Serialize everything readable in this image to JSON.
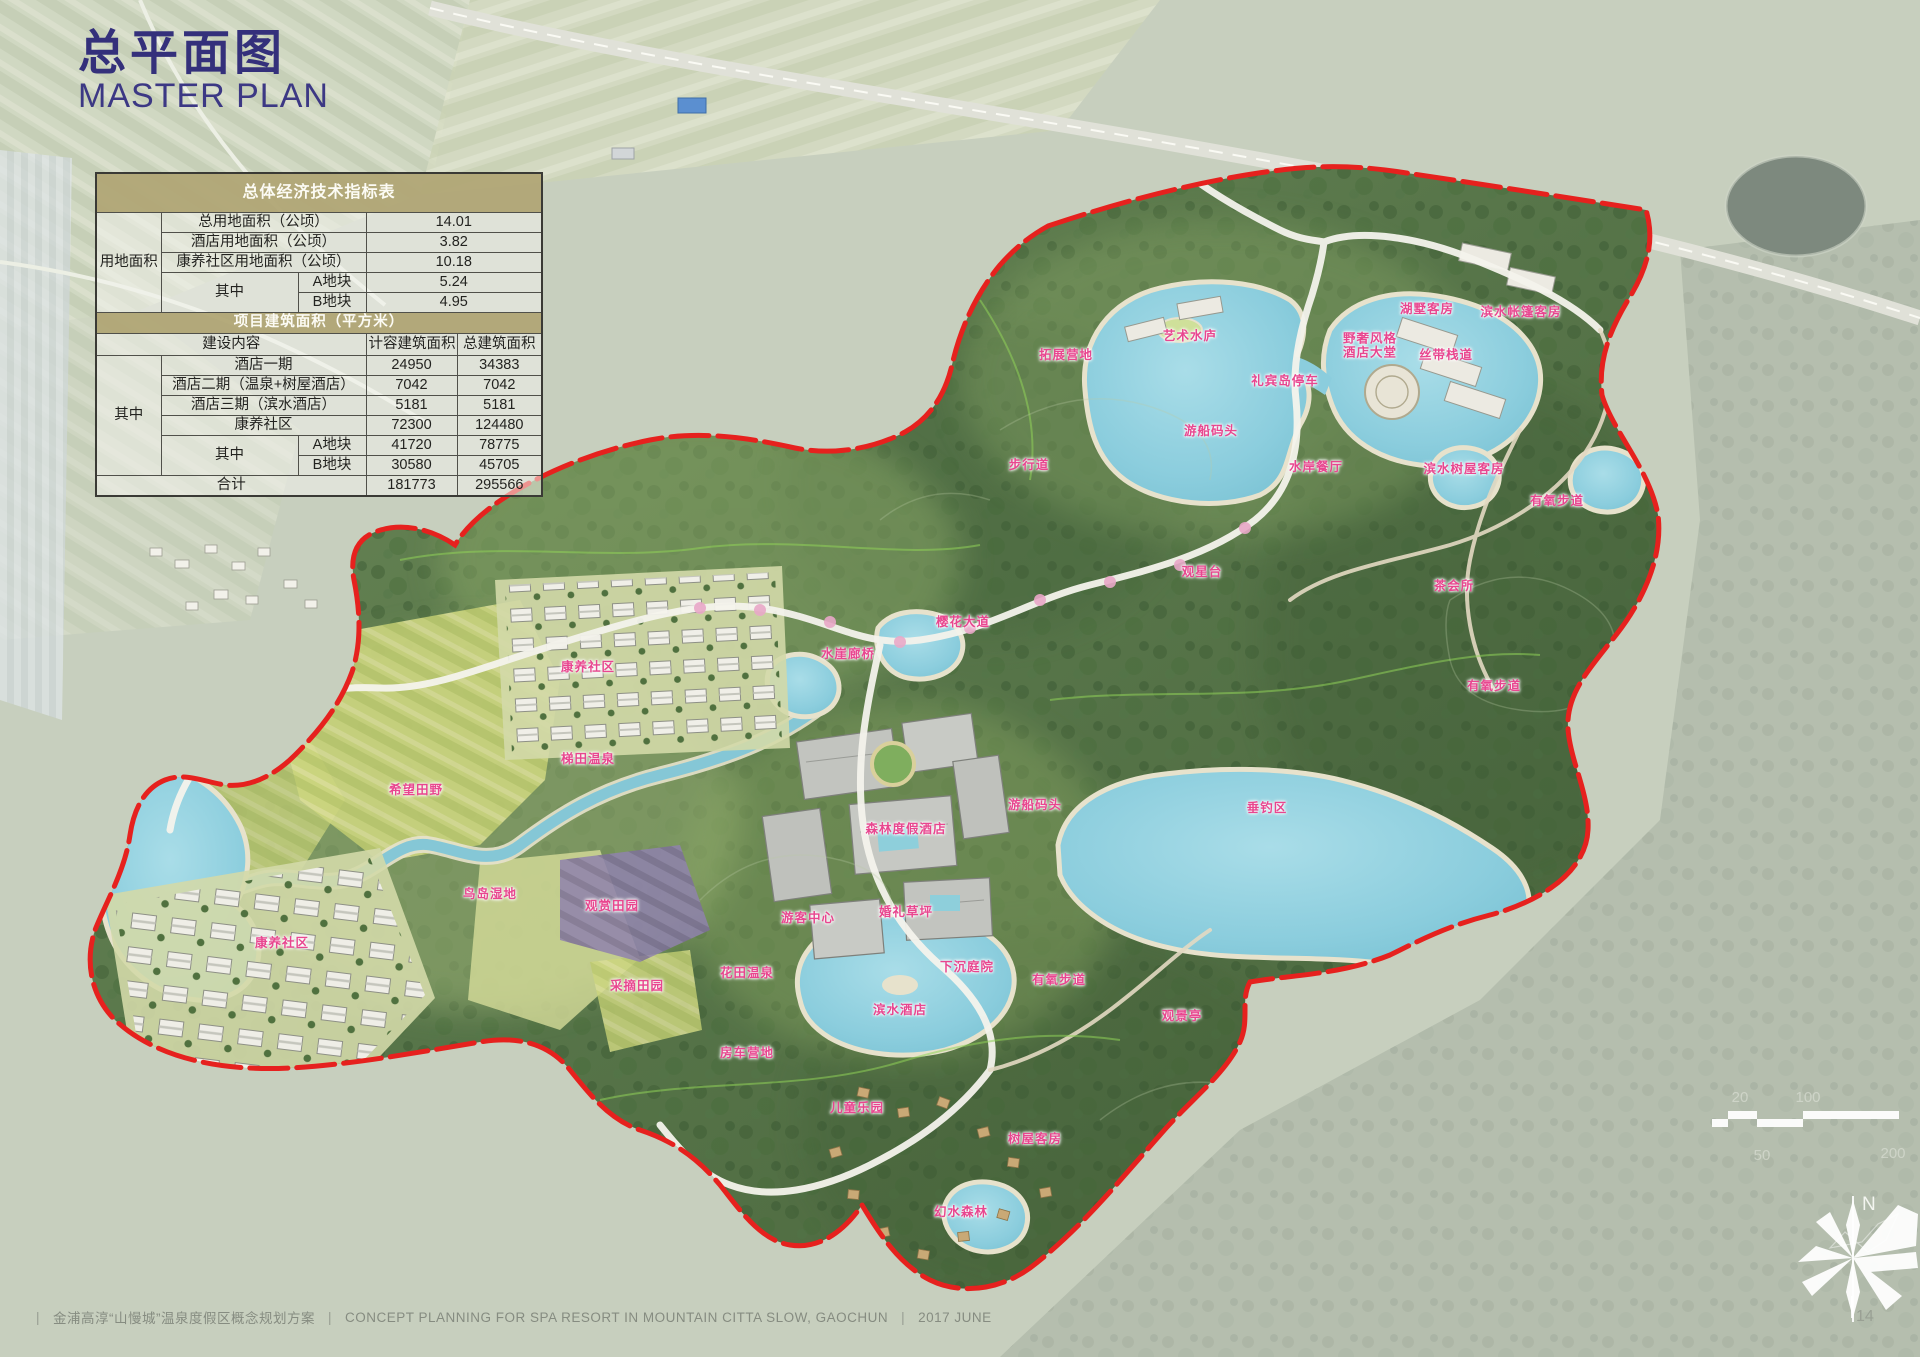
{
  "title": {
    "zh": "总平面图",
    "en": "MASTER PLAN"
  },
  "indicator_table": {
    "title": "总体经济技术指标表",
    "land_group_label": "用地面积",
    "rows": [
      {
        "label": "总用地面积（公顷）",
        "value": "14.01"
      },
      {
        "label": "酒店用地面积（公顷）",
        "value": "3.82"
      },
      {
        "label": "康养社区用地面积（公顷）",
        "value": "10.18"
      }
    ],
    "sub_label": "其中",
    "sub_rows": [
      {
        "label": "A地块",
        "value": "5.24"
      },
      {
        "label": "B地块",
        "value": "4.95"
      }
    ]
  },
  "area_table": {
    "title": "项目建筑面积（平方米）",
    "col_headers": [
      "建设内容",
      "计容建筑面积",
      "总建筑面积"
    ],
    "group_label": "其中",
    "rows": [
      {
        "label": "酒店一期",
        "far": "24950",
        "gfa": "34383"
      },
      {
        "label": "酒店二期（温泉+树屋酒店）",
        "far": "7042",
        "gfa": "7042"
      },
      {
        "label": "酒店三期（滨水酒店）",
        "far": "5181",
        "gfa": "5181"
      },
      {
        "label": "康养社区",
        "far": "72300",
        "gfa": "124480"
      }
    ],
    "sub_label": "其中",
    "sub_rows": [
      {
        "label": "A地块",
        "far": "41720",
        "gfa": "78775"
      },
      {
        "label": "B地块",
        "far": "30580",
        "gfa": "45705"
      }
    ],
    "total": {
      "label": "合计",
      "far": "181773",
      "gfa": "295566"
    }
  },
  "map": {
    "label_color": "#e8468f",
    "boundary_color": "#e6211e",
    "labels": [
      {
        "text": "拓展营地",
        "x": 1066,
        "y": 355
      },
      {
        "text": "艺术水庐",
        "x": 1190,
        "y": 336
      },
      {
        "text": "礼宾岛停车",
        "x": 1285,
        "y": 381
      },
      {
        "text": "野奢风格\n酒店大堂",
        "x": 1370,
        "y": 346
      },
      {
        "text": "湖墅客房",
        "x": 1427,
        "y": 309
      },
      {
        "text": "滨水帐篷客房",
        "x": 1521,
        "y": 312
      },
      {
        "text": "丝带栈道",
        "x": 1446,
        "y": 355
      },
      {
        "text": "游船码头",
        "x": 1211,
        "y": 431
      },
      {
        "text": "步行道",
        "x": 1029,
        "y": 465
      },
      {
        "text": "水岸餐厅",
        "x": 1316,
        "y": 467
      },
      {
        "text": "滨水树屋客房",
        "x": 1464,
        "y": 469
      },
      {
        "text": "有氧步道",
        "x": 1557,
        "y": 501
      },
      {
        "text": "观星台",
        "x": 1202,
        "y": 572
      },
      {
        "text": "茶会所",
        "x": 1454,
        "y": 586
      },
      {
        "text": "樱花大道",
        "x": 963,
        "y": 622
      },
      {
        "text": "水崖廊桥",
        "x": 848,
        "y": 654
      },
      {
        "text": "康养社区",
        "x": 588,
        "y": 667
      },
      {
        "text": "有氧步道",
        "x": 1494,
        "y": 686
      },
      {
        "text": "梯田温泉",
        "x": 588,
        "y": 759
      },
      {
        "text": "希望田野",
        "x": 416,
        "y": 790
      },
      {
        "text": "游船码头",
        "x": 1035,
        "y": 805
      },
      {
        "text": "垂钓区",
        "x": 1267,
        "y": 808
      },
      {
        "text": "森林度假酒店",
        "x": 906,
        "y": 829
      },
      {
        "text": "鸟岛湿地",
        "x": 490,
        "y": 894
      },
      {
        "text": "观赏田园",
        "x": 612,
        "y": 906
      },
      {
        "text": "婚礼草坪",
        "x": 906,
        "y": 912
      },
      {
        "text": "游客中心",
        "x": 808,
        "y": 918
      },
      {
        "text": "康养社区",
        "x": 282,
        "y": 943
      },
      {
        "text": "下沉庭院",
        "x": 967,
        "y": 967
      },
      {
        "text": "花田温泉",
        "x": 747,
        "y": 973
      },
      {
        "text": "有氧步道",
        "x": 1059,
        "y": 980
      },
      {
        "text": "采摘田园",
        "x": 637,
        "y": 986
      },
      {
        "text": "滨水酒店",
        "x": 900,
        "y": 1010
      },
      {
        "text": "观景亭",
        "x": 1182,
        "y": 1016
      },
      {
        "text": "房车营地",
        "x": 747,
        "y": 1053
      },
      {
        "text": "儿童乐园",
        "x": 857,
        "y": 1108
      },
      {
        "text": "树屋客房",
        "x": 1035,
        "y": 1139
      },
      {
        "text": "幻水森林",
        "x": 961,
        "y": 1212
      }
    ]
  },
  "scalebar": {
    "ticks": [
      "20",
      "100",
      "50",
      "200"
    ]
  },
  "compass": {
    "north_label": "N"
  },
  "footer": {
    "bar": "|",
    "zh": "金浦高淳“山慢城”温泉度假区概念规划方案",
    "en": "CONCEPT PLANNING FOR SPA RESORT IN MOUNTAIN CITTA SLOW, GAOCHUN",
    "date": "2017 JUNE",
    "page": "14"
  }
}
